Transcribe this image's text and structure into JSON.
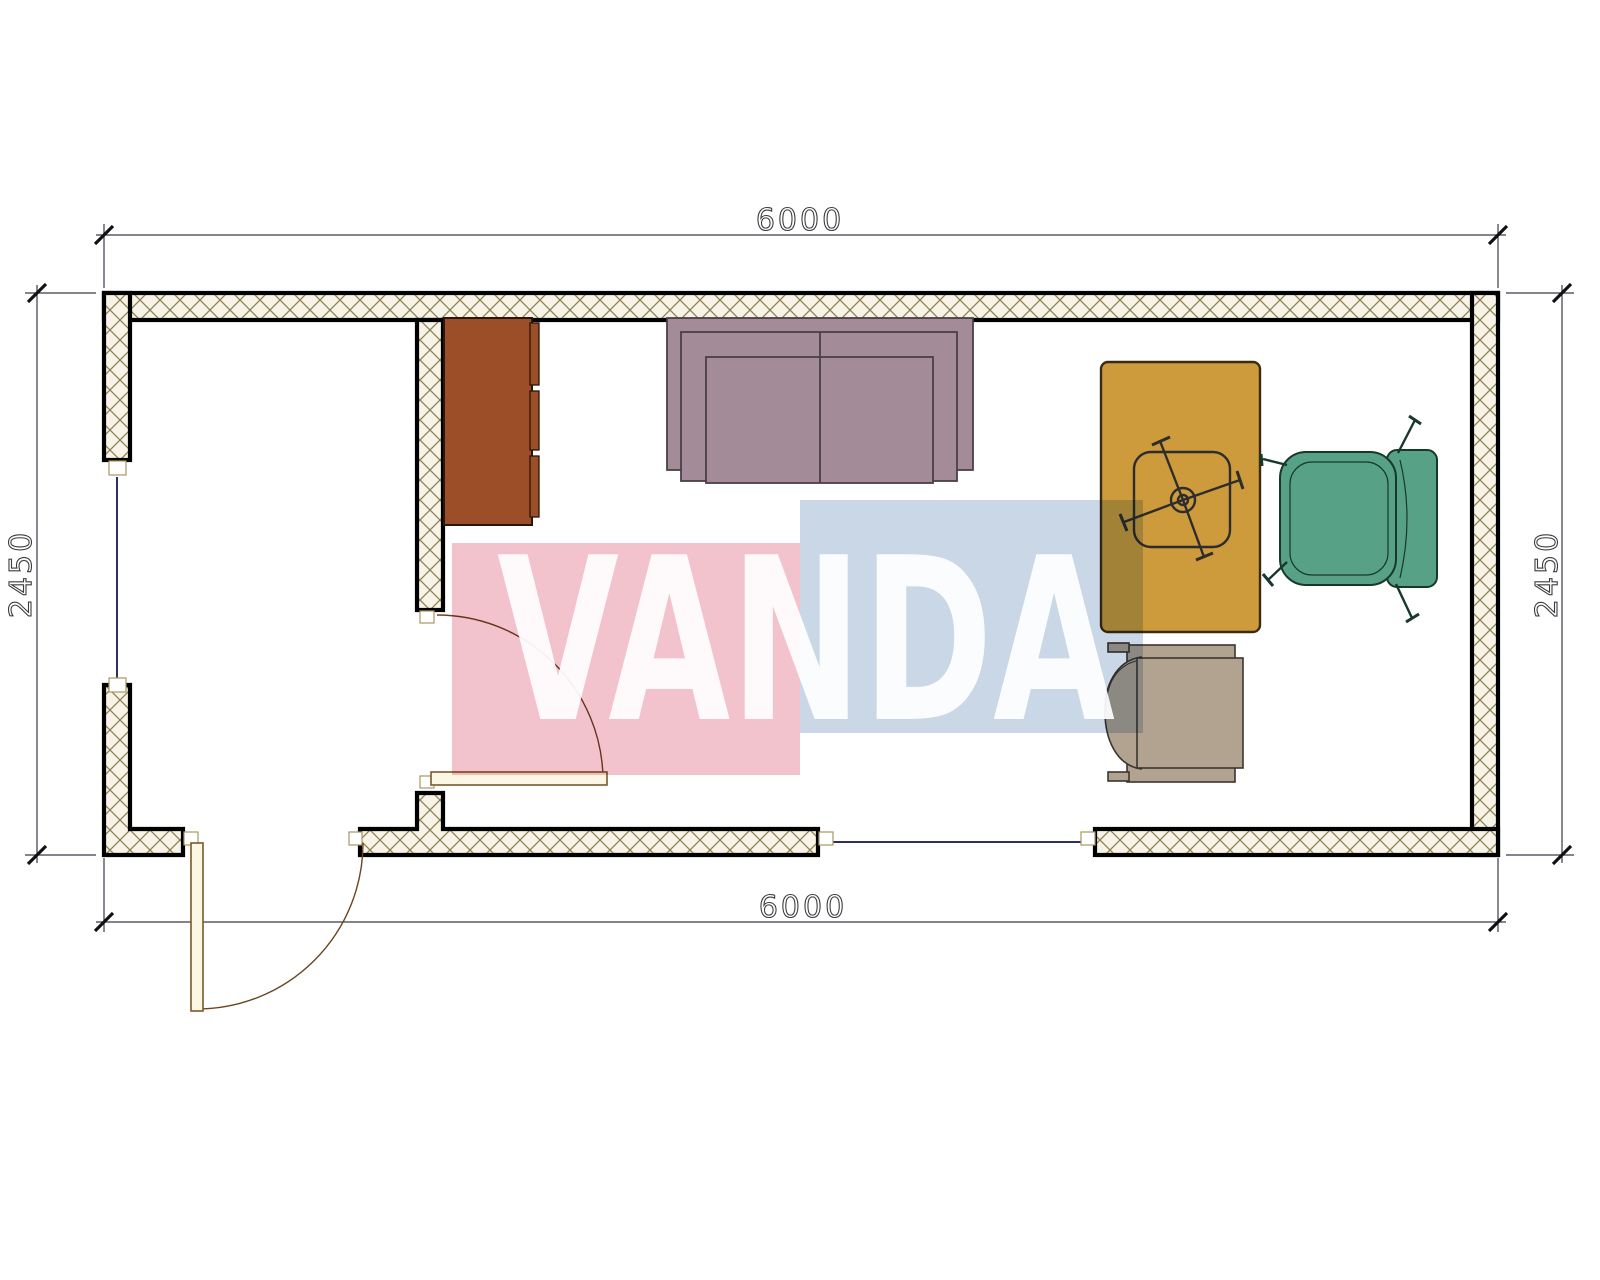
{
  "drawing": {
    "type": "floor-plan",
    "dimensions": {
      "top": "6000",
      "bottom": "6000",
      "left": "2450",
      "right": "2450"
    },
    "watermark": {
      "text": "VANDA",
      "pink": "#f2c3cd",
      "blue": "#c9d7e6"
    },
    "walls": {
      "outline": "#000000",
      "hatch_line": "#8d8156",
      "hatch_bg": "#f7f3e6",
      "window_line": "#2f2f60"
    },
    "furniture": {
      "cabinet": {
        "label": "cabinet",
        "color": "#9b4e27"
      },
      "sofa": {
        "label": "sofa",
        "color": "#a38b97"
      },
      "desk": {
        "label": "desk",
        "color": "#cd9a3c"
      },
      "office_chair": {
        "label": "office chair",
        "color": "#333333"
      },
      "armchair": {
        "label": "armchair",
        "color": "#57a287"
      },
      "guest_chair": {
        "label": "guest chair",
        "color": "#b2a391"
      }
    },
    "doors": {
      "leaf_fill": "#fcf6e4",
      "swing_color": "#6a4420"
    }
  }
}
